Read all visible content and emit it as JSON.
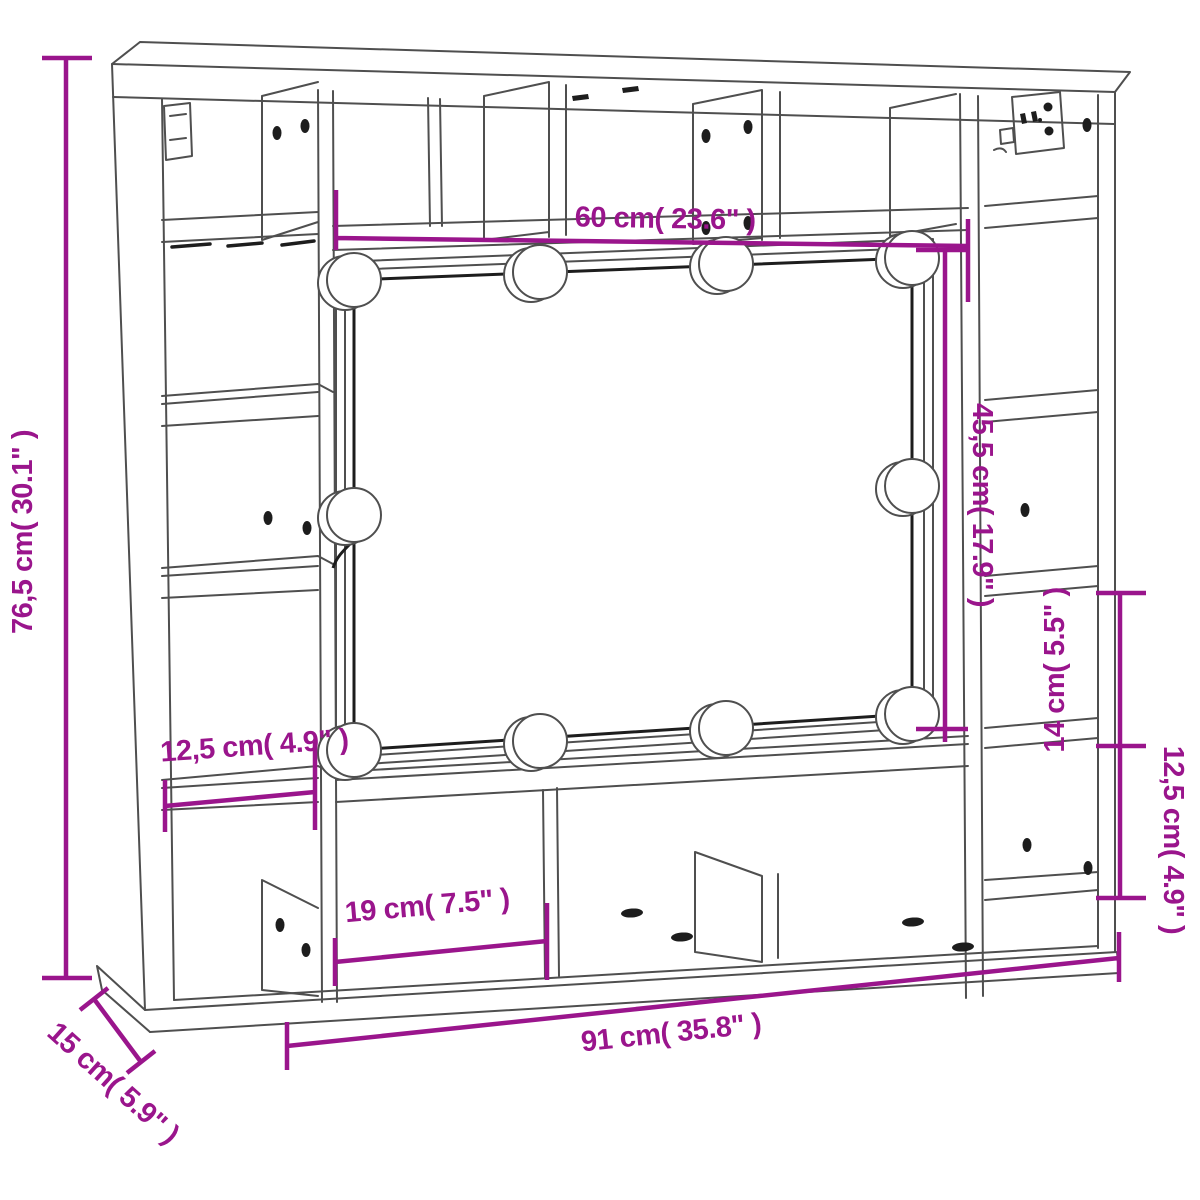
{
  "diagram": {
    "type": "furniture-dimension-line-drawing",
    "subject": "wall mirror cabinet with LED lights and open shelves",
    "style": "3d perspective outline drawing",
    "colors": {
      "accent": "#9A158C",
      "structure_line": "#4f4f4f",
      "detail_line": "#1d1d1d",
      "background": "#ffffff"
    },
    "led_bulb_count": 10,
    "dimensions": {
      "overall_height": {
        "label": "76,5 cm( 30.1\" )",
        "position": "left edge, vertical"
      },
      "mirror_width": {
        "label": "60 cm( 23.6\" )",
        "position": "top, horizontal"
      },
      "mirror_height": {
        "label": "45,5 cm( 17.9\" )",
        "position": "right of mirror, vertical"
      },
      "left_shelf_width": {
        "label": "12,5 cm( 4.9\" )",
        "position": "left shelf, horizontal"
      },
      "right_upper_shelf_height": {
        "label": "14 cm( 5.5\" )",
        "position": "right side, vertical"
      },
      "right_lower_shelf_height": {
        "label": "12,5 cm( 4.9\" )",
        "position": "right side, vertical"
      },
      "bottom_compartment_width": {
        "label": "19 cm( 7.5\" )",
        "position": "bottom left compartment, horizontal"
      },
      "overall_width": {
        "label": "91 cm( 35.8\" )",
        "position": "bottom, horizontal"
      },
      "depth": {
        "label": "15 cm( 5.9\" )",
        "position": "bottom-left corner, diagonal"
      }
    }
  }
}
